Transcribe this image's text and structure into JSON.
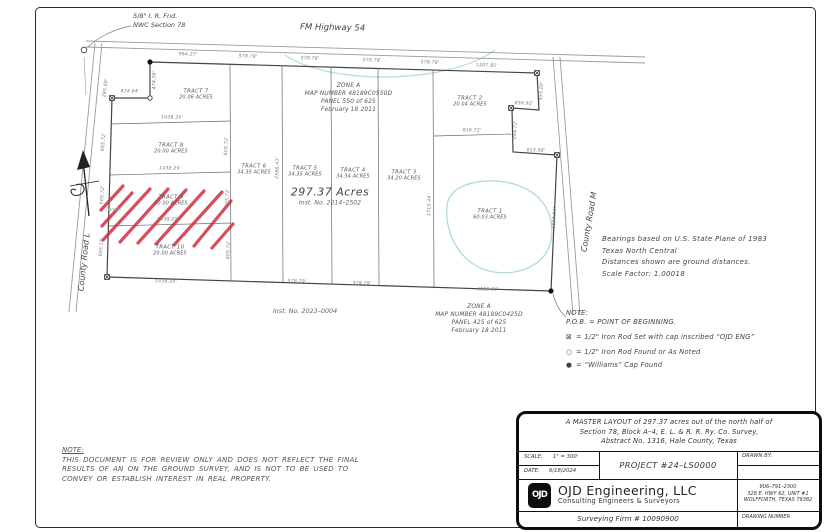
{
  "sheet": {
    "background": "#ffffff",
    "border_color": "#2a2a2a"
  },
  "map": {
    "highway_label": "FM Highway 54",
    "county_road_l": "County Road L",
    "county_road_m": "County Road M",
    "corner_note": {
      "lines": [
        "5/8\" I. R. Fnd.",
        "NWC Section 78"
      ]
    },
    "total_acres": "297.37 Acres",
    "total_inst": "Inst. No. 2014–2502",
    "inst_bottom": "Inst. No. 2023–0004",
    "well_label": "(well)",
    "zone_top": {
      "lines": [
        "ZONE A",
        "MAP NUMBER 48189C0550D",
        "PANEL 550 of 625",
        "February 18 2011"
      ]
    },
    "zone_bottom": {
      "lines": [
        "ZONE A",
        "MAP NUMBER 48189C0425D",
        "PANEL 425 of 625",
        "February 18 2011"
      ]
    },
    "tracts": [
      {
        "name": "TRACT 7",
        "acres": "20.06 ACRES"
      },
      {
        "name": "TRACT 8",
        "acres": "20.00 ACRES"
      },
      {
        "name": "TRACT 9",
        "acres": "20.00 ACRES"
      },
      {
        "name": "TRACT 10",
        "acres": "20.00 ACRES"
      },
      {
        "name": "TRACT 6",
        "acres": "34.35 ACRES"
      },
      {
        "name": "TRACT 5",
        "acres": "34.35 ACRES"
      },
      {
        "name": "TRACT 4",
        "acres": "34.34 ACRES"
      },
      {
        "name": "TRACT 3",
        "acres": "34.20 ACRES"
      },
      {
        "name": "TRACT 2",
        "acres": "20.04 ACRES"
      },
      {
        "name": "TRACT 1",
        "acres": "60.03 ACRES"
      }
    ],
    "dimensions": [
      "964.27'",
      "578.78'",
      "578.78'",
      "578.78'",
      "578.78'",
      "1207.81'",
      "474.56'",
      "474.84'",
      "285.69'",
      "1438.29'",
      "1438.29'",
      "1438.29'",
      "1438.29'",
      "605.72'",
      "605.72'",
      "605.15'",
      "605.72'",
      "605.72'",
      "605.72'",
      "2586.43'",
      "1715.44'",
      "455.00'",
      "856.92'",
      "244.72'",
      "816.72'",
      "815.98'",
      "1830.84'",
      "1635.00'",
      "578.79'",
      "578.78'"
    ],
    "hatch_color": "#cf2e3e",
    "wetland_color": "#aedbd6"
  },
  "notes": {
    "bearings": [
      "Bearings based on U.S. State Plane of 1983",
      "Texas North Central",
      "Distances shown are ground distances.",
      "Scale Factor: 1.00018"
    ],
    "legend_title": "NOTE:",
    "legend_pob": "P.O.B.  =  POINT OF BEGINNING.",
    "legend_items": [
      {
        "symbol": "⊠",
        "text": "=  1/2\" Iron Rod Set with cap inscribed “OJD ENG”"
      },
      {
        "symbol": "○",
        "text": "=  1/2\" Iron Rod Found or As Noted"
      },
      {
        "symbol": "●",
        "text": "=  “Williams” Cap Found"
      }
    ],
    "review_title": "NOTE:",
    "review_lines": [
      "THIS DOCUMENT IS FOR REVIEW ONLY AND DOES NOT REFLECT THE FINAL",
      "RESULTS OF AN ON THE GROUND SURVEY, AND IS NOT TO BE USED TO",
      "CONVEY OR ESTABLISH INTEREST IN REAL PROPERTY."
    ]
  },
  "titleblock": {
    "master_layout_lines": [
      "A MASTER LAYOUT of 297.37 acres out of the north half of",
      "Section 78, Block A–4, E. L. & R. R. Ry. Co. Survey,",
      "Abstract No. 1316, Hale County, Texas"
    ],
    "scale_label": "SCALE:",
    "scale_value": "1\" = 300'",
    "date_label": "DATE:",
    "date_value": "6/18/2024",
    "project": "PROJECT #24–LS0000",
    "drawn_by_label": "DRAWN BY:",
    "logo_text": "OJD",
    "company_name": "OJD Engineering, LLC",
    "company_tagline": "Consulting Engineers & Surveyors",
    "phone": "806–791–2300",
    "address_line1": "328 E. HWY 62, UNIT #1",
    "address_line2": "WOLFFORTH, TEXAS 79382",
    "firm_number": "Surveying Firm # 10090900",
    "drawing_number_label": "DRAWING NUMBER"
  }
}
